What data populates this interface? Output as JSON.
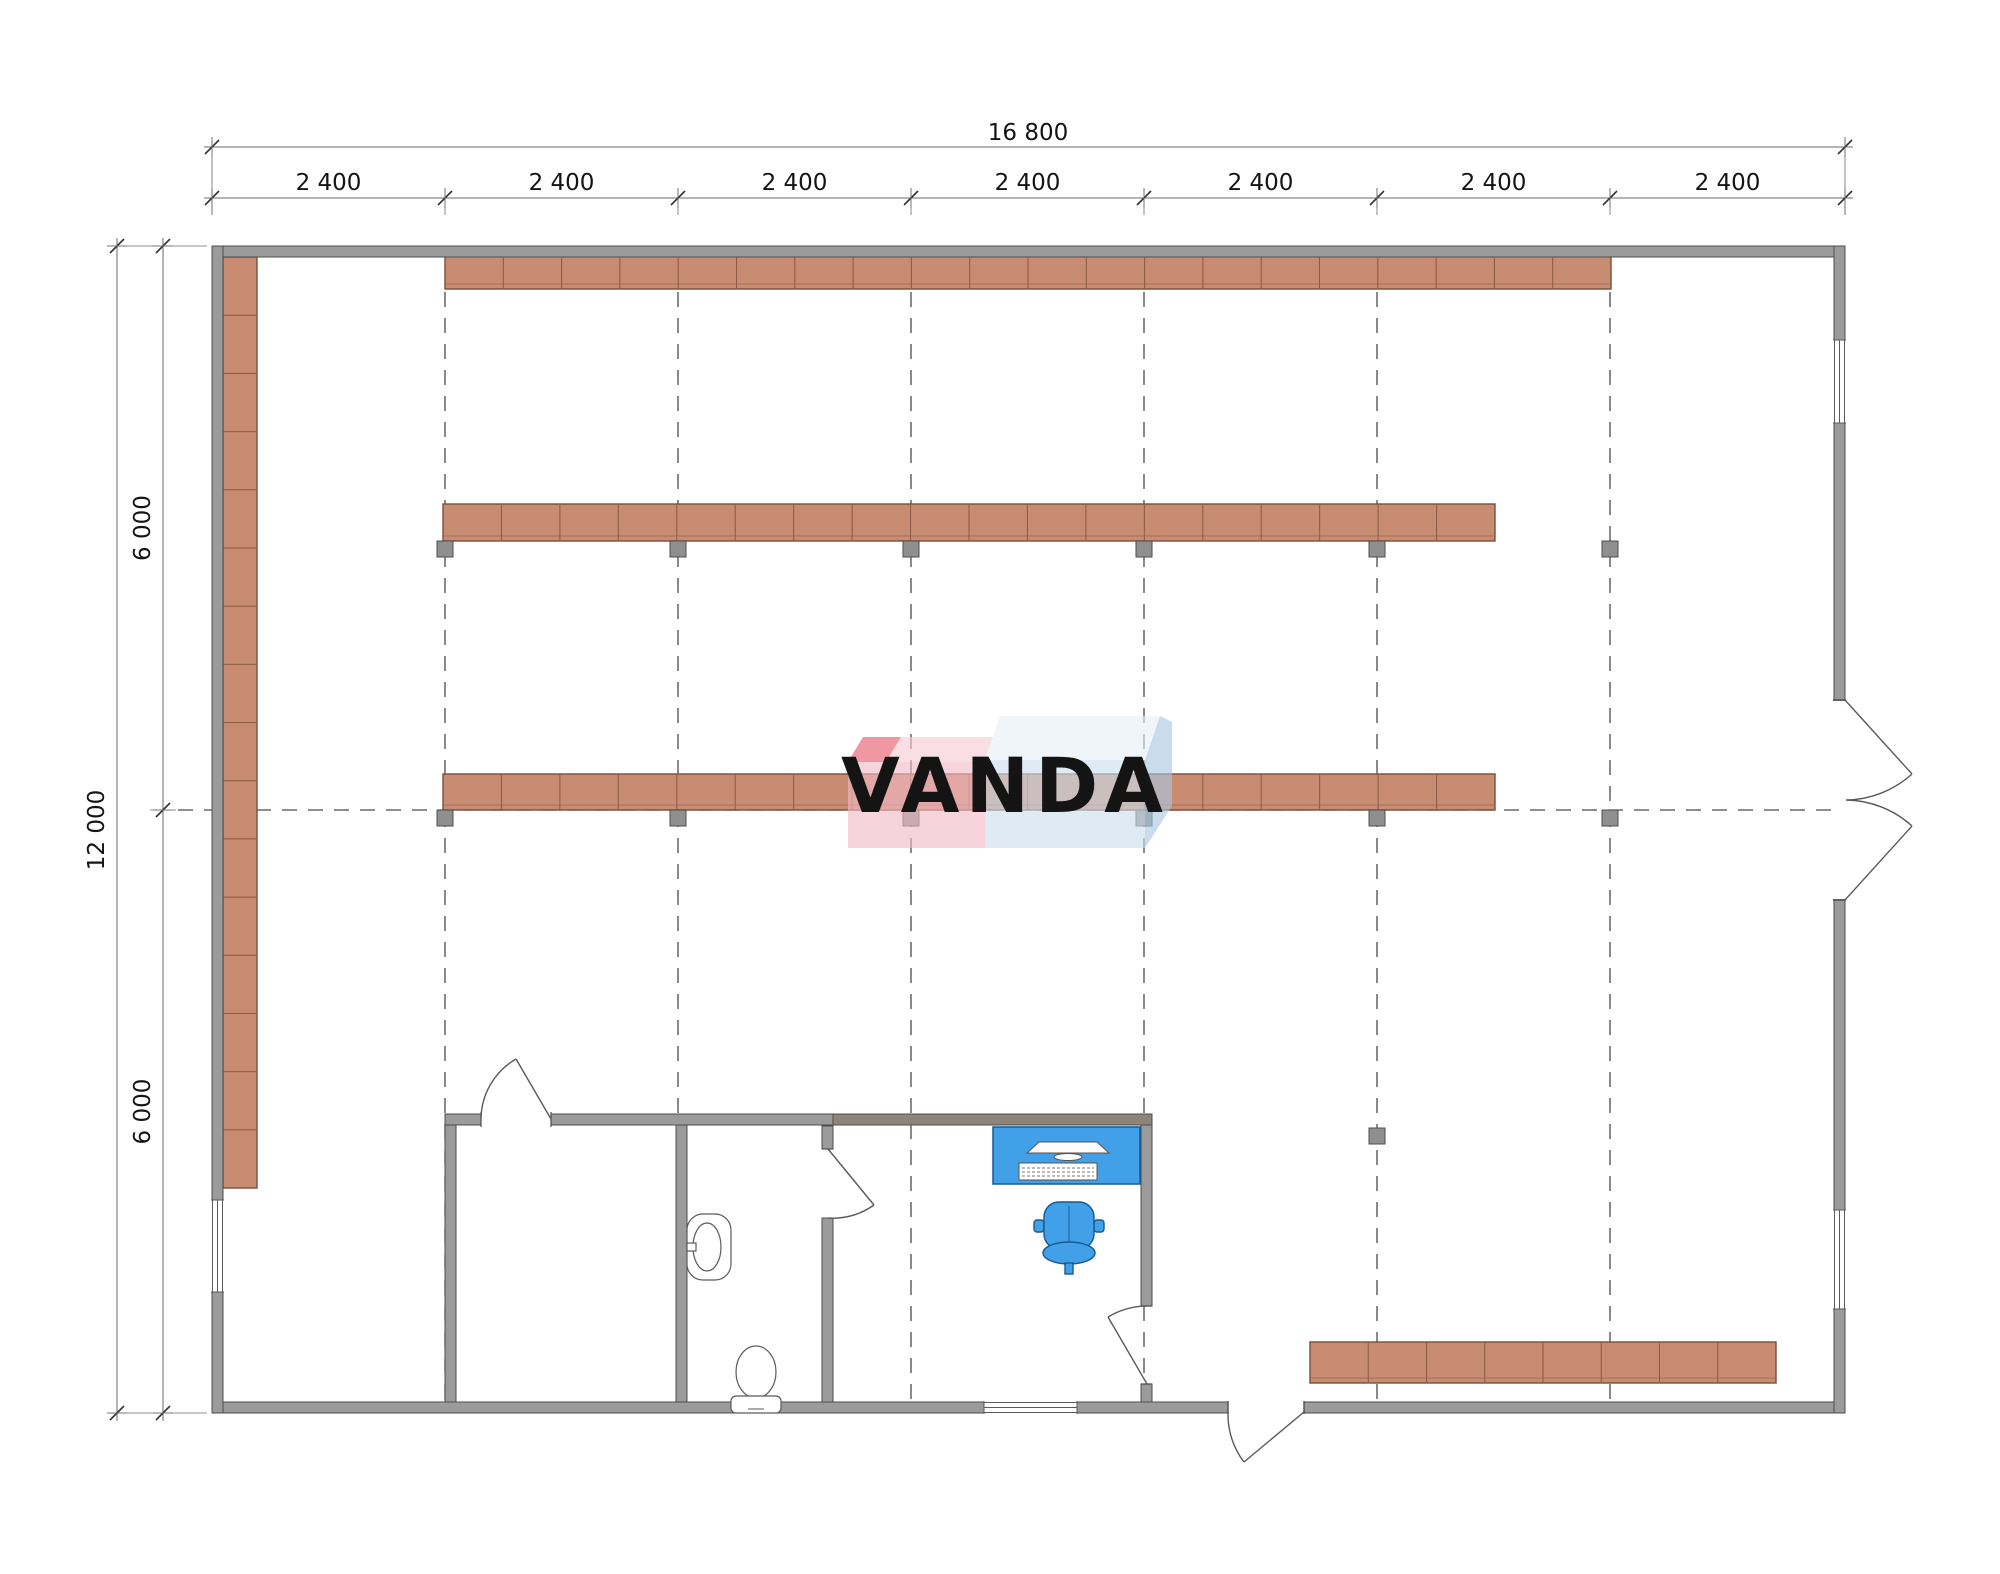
{
  "drawing": {
    "type": "warehouse-floor-plan",
    "background": "#ffffff"
  },
  "dimensions": {
    "top_total": "16 800",
    "top_bays": [
      "2 400",
      "2 400",
      "2 400",
      "2 400",
      "2 400",
      "2 400",
      "2 400"
    ],
    "left_total": "12 000",
    "left_halves": [
      "6 000",
      "6 000"
    ]
  },
  "logo": {
    "text": "VANDA",
    "pink": "#f3bac7",
    "pink_top": "#f6cdd6",
    "red": "#e8586e",
    "blue": "#ccdeee",
    "blue_top": "#e7f0f8",
    "blue_side": "#aac8e2",
    "text_color": "rgba(255,255,255,0.88)"
  },
  "colors": {
    "wall_fill": "#9b9b9b",
    "wall_stroke": "#4e4e4e",
    "inner_wall_tan": "#8e8578",
    "shelf_fill": "#c78c71",
    "shelf_stroke": "#7a4e39",
    "shelf_divider": "#8b5a43",
    "column_fill": "#8f8f8f",
    "dash": "#4a4a4a",
    "dim_line": "#6b6b6b",
    "fixture_stroke": "#5a5a5a",
    "accent_blue": "#42a0e8",
    "accent_blue_stroke": "#155a90"
  },
  "structure": {
    "grid_all_x": [
      212,
      445,
      678,
      911,
      1144,
      1377,
      1610,
      1845
    ],
    "grid_dashed_x": [
      445,
      678,
      911,
      1144,
      1377,
      1610
    ],
    "grid_y_top": 292,
    "grid_y_bottom": 1400,
    "axis_y": 810,
    "axis_x1": 178,
    "axis_x2": 1836,
    "columns": [
      {
        "x": 445,
        "y": 549
      },
      {
        "x": 678,
        "y": 549
      },
      {
        "x": 911,
        "y": 549
      },
      {
        "x": 1144,
        "y": 549
      },
      {
        "x": 1377,
        "y": 549
      },
      {
        "x": 1610,
        "y": 549
      },
      {
        "x": 445,
        "y": 818
      },
      {
        "x": 678,
        "y": 818
      },
      {
        "x": 911,
        "y": 818
      },
      {
        "x": 1144,
        "y": 818
      },
      {
        "x": 1377,
        "y": 818
      },
      {
        "x": 1610,
        "y": 818
      },
      {
        "x": 1144,
        "y": 1136
      },
      {
        "x": 1377,
        "y": 1136
      }
    ],
    "racks": [
      {
        "name": "top-rack",
        "x": 445,
        "y": 256,
        "w": 1166,
        "h": 33,
        "segments": 20,
        "dir": "h"
      },
      {
        "name": "upper-middle-rack",
        "x": 443,
        "y": 504,
        "w": 1052,
        "h": 37,
        "segments": 18,
        "dir": "h"
      },
      {
        "name": "lower-middle-rack",
        "x": 443,
        "y": 774,
        "w": 1052,
        "h": 36,
        "segments": 18,
        "dir": "h"
      },
      {
        "name": "bottom-right-rack",
        "x": 1310,
        "y": 1342,
        "w": 466,
        "h": 41,
        "segments": 8,
        "dir": "h"
      },
      {
        "name": "left-wall-rack",
        "x": 223,
        "y": 257,
        "w": 34,
        "h": 931,
        "segments": 16,
        "dir": "v"
      }
    ],
    "dim_geometry": {
      "top_line1_y": 147,
      "top_line2_y": 198,
      "left_outer_x": 117,
      "left_inner_x": 163,
      "left_y_points": [
        246,
        810,
        1413
      ]
    }
  }
}
